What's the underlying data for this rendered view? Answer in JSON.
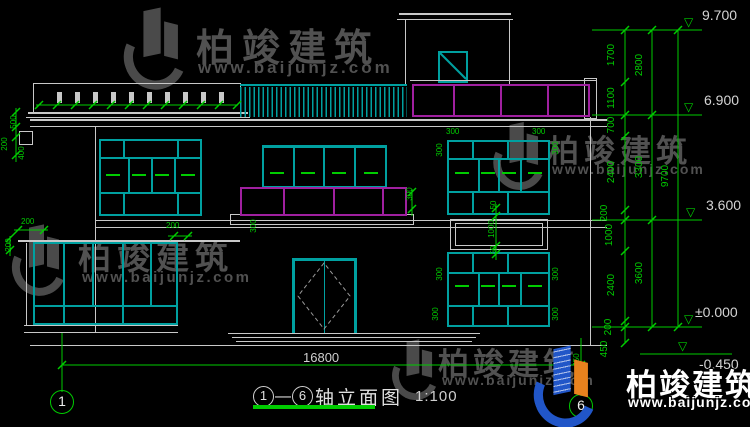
{
  "watermark": {
    "brand": "柏竣建筑",
    "url": "www.baijunjz.com"
  },
  "title": {
    "axis_from": "1",
    "axis_to": "6",
    "dash": "—",
    "text": "轴立面图",
    "scale": "1:100"
  },
  "axis_bubbles": {
    "left": "1",
    "right": "6"
  },
  "dimensions": {
    "total_width": "16800",
    "levels": [
      "9.700",
      "6.900",
      "3.600",
      "±0.000",
      "-0.450"
    ],
    "chain_inner": [
      "1700",
      "1100",
      "700",
      "2400",
      "200",
      "1000",
      "2400",
      "200",
      "450"
    ],
    "chain_middle": [
      "2800",
      "3300",
      "3600"
    ],
    "chain_total": "9700",
    "small": [
      "500",
      "200",
      "400",
      "200",
      "200",
      "200",
      "300",
      "300",
      "300",
      "300",
      "300",
      "300",
      "50",
      "1000",
      "50",
      "300",
      "300",
      "300",
      "300",
      "450"
    ]
  },
  "colors": {
    "line": "#c8c8c8",
    "cyan": "#00a0a0",
    "magenta": "#a020a0",
    "dim_green": "#00cc00",
    "watermark_gray": "#565656",
    "logo_blue": "#2156c8",
    "logo_orange": "#e8821e"
  }
}
